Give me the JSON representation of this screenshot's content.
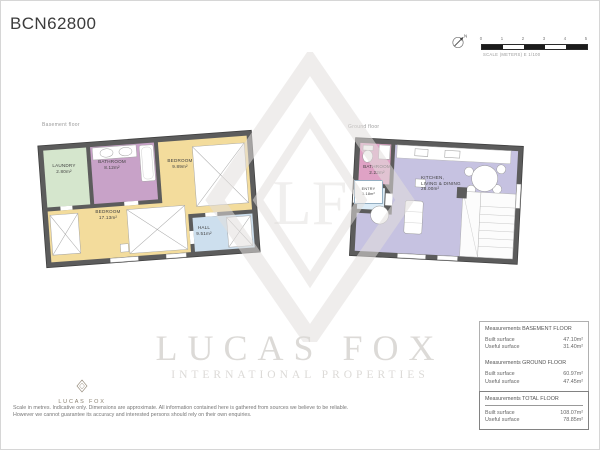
{
  "title": "BCN62800",
  "scale_bar": {
    "north_label": "N",
    "ticks": [
      "0",
      "1",
      "2",
      "3",
      "4",
      "5"
    ],
    "caption": "SCALE (METERS) E 1/100"
  },
  "watermark": {
    "monogram": "LF",
    "name": "LUCAS FOX",
    "tagline": "INTERNATIONAL PROPERTIES"
  },
  "plans": {
    "basement": {
      "label": "Basement floor",
      "rooms": [
        {
          "name": "LAUNDRY",
          "area": "2.80m²"
        },
        {
          "name": "BATHROOM",
          "area": "8.12m²"
        },
        {
          "name": "BEDROOM",
          "area": "9.89m²"
        },
        {
          "name": "BEDROOM",
          "area": "17.13m²"
        },
        {
          "name": "HALL",
          "area": "9.51m²"
        }
      ]
    },
    "ground": {
      "label": "Ground floor",
      "rooms": [
        {
          "name": "BATHROOM",
          "area": "2.22m²"
        },
        {
          "name": "ENTRY",
          "area": "1.18m²"
        },
        {
          "name": "KITCHEN,\nLIVING & DINING",
          "area": "28.00m²"
        }
      ]
    }
  },
  "colors": {
    "wall": "#5c5c5c",
    "laundry": "#d5e6cd",
    "bathroom_basement": "#c8a2c8",
    "bedroom": "#f3dc9c",
    "hall": "#cddfee",
    "bathroom_ground": "#dfa2c5",
    "entry": "#dcecf7",
    "kitchen_living": "#c6c2e1",
    "brand": "#8a8171"
  },
  "measurements": {
    "sections": [
      {
        "title": "Measurements BASEMENT FLOOR",
        "rows": [
          {
            "label": "Built surface",
            "value": "47.10m²"
          },
          {
            "label": "Useful surface",
            "value": "31.40m²"
          }
        ]
      },
      {
        "title": "Measurements GROUND FLOOR",
        "rows": [
          {
            "label": "Built surface",
            "value": "60.97m²"
          },
          {
            "label": "Useful surface",
            "value": "47.45m²"
          }
        ]
      },
      {
        "title": "Measurements TOTAL FLOOR",
        "rows": [
          {
            "label": "Built surface",
            "value": "108.07m²"
          },
          {
            "label": "Useful surface",
            "value": "78.85m²"
          }
        ]
      }
    ]
  },
  "footer": {
    "brand": "LUCAS FOX",
    "disclaimer_line1": "Scale in metres. Indicative only. Dimensions are approximate. All information contained here is gathered from sources we believe to be reliable.",
    "disclaimer_line2": "However we cannot guarantee its accuracy and interested persons should rely on their own enquiries."
  }
}
